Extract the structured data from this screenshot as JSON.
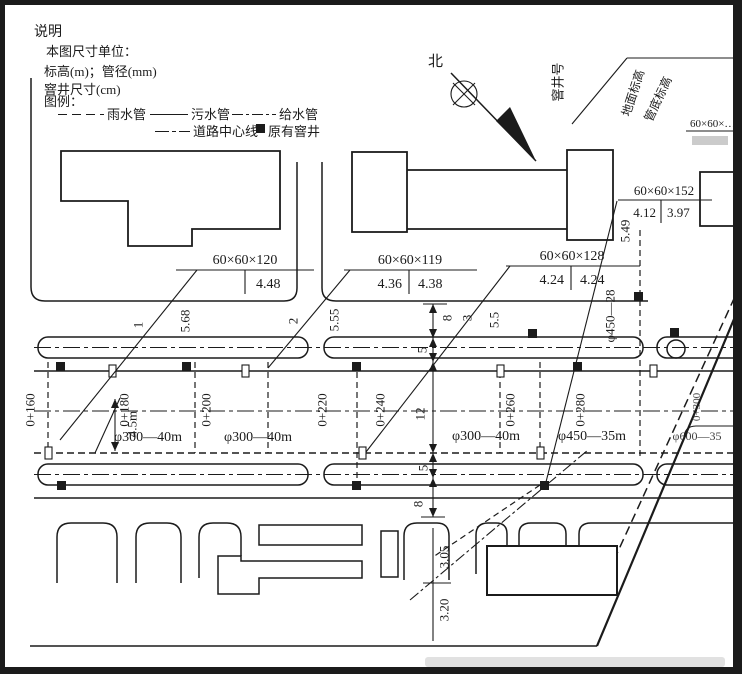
{
  "frame": {
    "ink": "#1b1b1b",
    "paper": "#ffffff"
  },
  "notes": {
    "title": "说明",
    "unit_line": "本图尺寸单位：",
    "elev_line": "标高(m)；管径(mm)",
    "well_line": "窨井尺寸(cm)",
    "legend_line": "图例：",
    "rain": "雨水管",
    "sewage": "污水管",
    "water": "给水管",
    "centerline": "道路中心线",
    "existing_well": "原有窨井"
  },
  "north": {
    "label": "北"
  },
  "well_table": {
    "well_no": "窨井号",
    "ground_elev": "地面标高",
    "invert_elev": "管底标高"
  },
  "callouts": {
    "c1": {
      "size": "60×60×120",
      "left": "",
      "right": "4.48"
    },
    "c2": {
      "size": "60×60×119",
      "left": "4.36",
      "right": "4.38"
    },
    "c3": {
      "size": "60×60×128",
      "left": "4.24",
      "right": "4.24"
    },
    "c4": {
      "size": "60×60×152",
      "left": "4.12",
      "right": "3.97"
    },
    "c5": {
      "size": "60×60×…"
    }
  },
  "wells": {
    "no1": "1",
    "no2": "2",
    "no3": "3",
    "elev1": "5.68",
    "elev2": "5.55",
    "elev3": "5.5",
    "elev4": "5.49"
  },
  "stations": {
    "s1": "0+160",
    "s2": "0+180",
    "s3": "0+200",
    "s4": "0+220",
    "s5": "0+240",
    "s6": "0+260",
    "s7": "0+280",
    "s8": "0+300"
  },
  "pipes": {
    "seg1": "φ300—40m",
    "seg2": "φ300—40m",
    "seg3": "φ300—40m",
    "seg4": "φ450—35m",
    "seg5": "φ450—28",
    "seg6": "φ600—35"
  },
  "dims": {
    "a": "8",
    "b": "5",
    "c": "12",
    "d": "5",
    "e": "8",
    "road_width": "4.5m",
    "elev_top": "3.05",
    "elev_bottom": "3.20"
  }
}
